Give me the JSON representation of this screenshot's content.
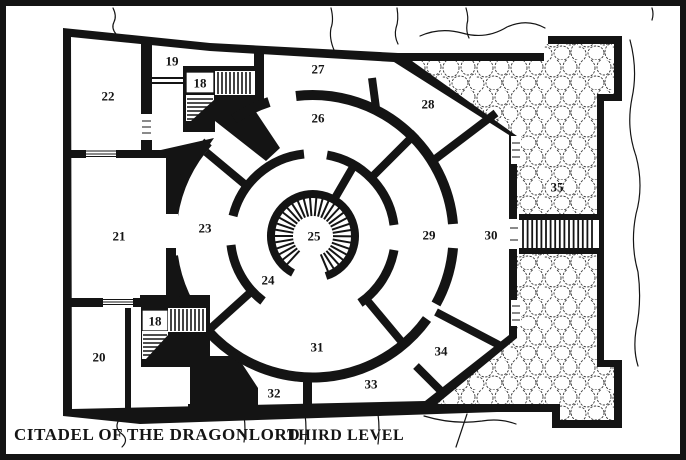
{
  "map": {
    "title": "CITADEL OF THE DRAGONLORD",
    "level_label": "THIRD LEVEL",
    "colors": {
      "ink": "#141414",
      "paper": "#ffffff"
    },
    "rooms": [
      {
        "label": "18",
        "x": 200,
        "y": 83,
        "boxed": true
      },
      {
        "label": "19",
        "x": 172,
        "y": 61,
        "boxed": false
      },
      {
        "label": "22",
        "x": 108,
        "y": 96,
        "boxed": false
      },
      {
        "label": "21",
        "x": 119,
        "y": 236,
        "boxed": false
      },
      {
        "label": "20",
        "x": 99,
        "y": 357,
        "boxed": false
      },
      {
        "label": "18",
        "x": 155,
        "y": 321,
        "boxed": true
      },
      {
        "label": "23",
        "x": 205,
        "y": 228,
        "boxed": false
      },
      {
        "label": "24",
        "x": 268,
        "y": 280,
        "boxed": false
      },
      {
        "label": "25",
        "x": 314,
        "y": 236,
        "boxed": false
      },
      {
        "label": "26",
        "x": 318,
        "y": 118,
        "boxed": false
      },
      {
        "label": "27",
        "x": 318,
        "y": 69,
        "boxed": false
      },
      {
        "label": "28",
        "x": 428,
        "y": 104,
        "boxed": false
      },
      {
        "label": "29",
        "x": 429,
        "y": 235,
        "boxed": false
      },
      {
        "label": "30",
        "x": 491,
        "y": 235,
        "boxed": false
      },
      {
        "label": "31",
        "x": 317,
        "y": 347,
        "boxed": false
      },
      {
        "label": "32",
        "x": 274,
        "y": 393,
        "boxed": false
      },
      {
        "label": "33",
        "x": 371,
        "y": 384,
        "boxed": false
      },
      {
        "label": "34",
        "x": 441,
        "y": 351,
        "boxed": false
      },
      {
        "label": "35",
        "x": 557,
        "y": 187,
        "boxed": false
      }
    ]
  }
}
